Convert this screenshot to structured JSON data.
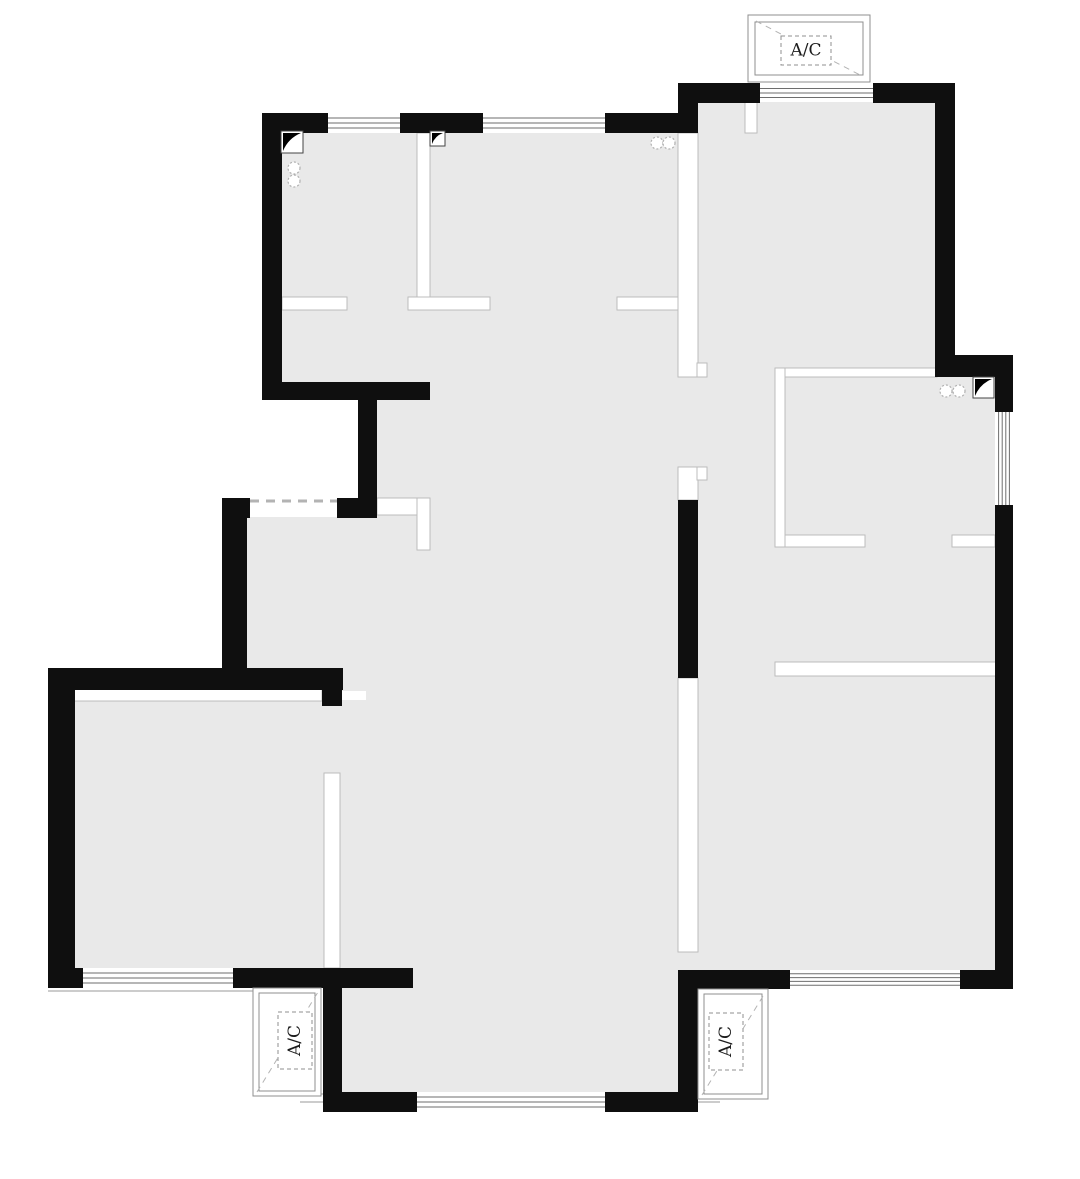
{
  "plan": {
    "canvas": {
      "width": 1080,
      "height": 1179,
      "background": "#ffffff"
    },
    "ac_label": "A/C",
    "colors": {
      "wall": "#0f0f0f",
      "floor": "#e9e9e9",
      "partition_fill": "#ffffff",
      "partition_stroke": "#bcbcbc",
      "glass_line": "#6e6e6e",
      "sill_line": "#9a9a9a",
      "platform_stroke": "#8f8f8f",
      "dash_line": "#b3b3b3",
      "label_text": "#1c1c1c",
      "flue_stroke": "#444444",
      "pipe_stroke": "#b0b0b0"
    },
    "floors": [
      [
        276,
        123,
        414,
        277
      ],
      [
        686,
        92,
        262,
        890
      ],
      [
        944,
        362,
        60,
        620
      ],
      [
        366,
        377,
        324,
        721
      ],
      [
        232,
        517,
        200,
        174
      ],
      [
        55,
        676,
        282,
        306
      ],
      [
        337,
        700,
        35,
        395
      ]
    ],
    "walls": [
      [
        262,
        113,
        20,
        287
      ],
      [
        262,
        113,
        66,
        20
      ],
      [
        400,
        113,
        83,
        20
      ],
      [
        605,
        113,
        93,
        20
      ],
      [
        678,
        100,
        20,
        33
      ],
      [
        678,
        83,
        82,
        20
      ],
      [
        873,
        83,
        82,
        20
      ],
      [
        935,
        95,
        20,
        282
      ],
      [
        935,
        355,
        78,
        22
      ],
      [
        995,
        377,
        18,
        35
      ],
      [
        995,
        505,
        18,
        484
      ],
      [
        698,
        970,
        92,
        19
      ],
      [
        960,
        970,
        53,
        19
      ],
      [
        678,
        500,
        20,
        178
      ],
      [
        678,
        970,
        20,
        142
      ],
      [
        323,
        1092,
        94,
        20
      ],
      [
        605,
        1092,
        93,
        20
      ],
      [
        323,
        970,
        19,
        142
      ],
      [
        48,
        968,
        35,
        20
      ],
      [
        233,
        968,
        180,
        20
      ],
      [
        48,
        672,
        27,
        316
      ],
      [
        48,
        668,
        295,
        22
      ],
      [
        322,
        668,
        20,
        38
      ],
      [
        222,
        498,
        25,
        192
      ],
      [
        222,
        498,
        28,
        20
      ],
      [
        337,
        498,
        40,
        20
      ],
      [
        358,
        400,
        19,
        100
      ],
      [
        282,
        382,
        148,
        18
      ]
    ],
    "partitions": [
      [
        417,
        133,
        13,
        164
      ],
      [
        282,
        297,
        65,
        13
      ],
      [
        408,
        297,
        82,
        13
      ],
      [
        617,
        297,
        61,
        13
      ],
      [
        678,
        133,
        20,
        244
      ],
      [
        697,
        363,
        10,
        14
      ],
      [
        678,
        467,
        20,
        33
      ],
      [
        697,
        467,
        10,
        13
      ],
      [
        377,
        498,
        53,
        17
      ],
      [
        417,
        498,
        13,
        52
      ],
      [
        775,
        368,
        10,
        179
      ],
      [
        785,
        368,
        152,
        9
      ],
      [
        785,
        535,
        80,
        12
      ],
      [
        952,
        535,
        43,
        12
      ],
      [
        775,
        662,
        223,
        14
      ],
      [
        68,
        688,
        254,
        13
      ],
      [
        324,
        773,
        16,
        195
      ],
      [
        678,
        678,
        20,
        274
      ],
      [
        745,
        100,
        12,
        33
      ]
    ],
    "windows": [
      {
        "x": 328,
        "y": 113,
        "w": 72,
        "h": 20,
        "n": 3,
        "o": "h"
      },
      {
        "x": 483,
        "y": 113,
        "w": 122,
        "h": 20,
        "n": 3,
        "o": "h"
      },
      {
        "x": 760,
        "y": 84,
        "w": 113,
        "h": 18,
        "n": 3,
        "o": "h"
      },
      {
        "x": 995,
        "y": 412,
        "w": 18,
        "h": 93,
        "n": 4,
        "o": "v"
      },
      {
        "x": 790,
        "y": 970,
        "w": 170,
        "h": 19,
        "n": 4,
        "o": "h"
      },
      {
        "x": 83,
        "y": 968,
        "w": 150,
        "h": 20,
        "n": 3,
        "o": "h"
      },
      {
        "x": 417,
        "y": 1092,
        "w": 188,
        "h": 20,
        "n": 3,
        "o": "h"
      }
    ],
    "sills": [
      [
        300,
        1094,
        720,
        1094
      ],
      [
        300,
        1102,
        720,
        1102
      ],
      [
        48,
        991,
        321,
        991
      ]
    ],
    "dashed_openings": [
      [
        250,
        501,
        337,
        501
      ]
    ],
    "flues": [
      {
        "x": 281,
        "y": 131,
        "s": 22
      },
      {
        "x": 430,
        "y": 131,
        "s": 15
      },
      {
        "x": 973,
        "y": 377,
        "s": 21
      }
    ],
    "pipes": [
      [
        294,
        168
      ],
      [
        294,
        181
      ],
      [
        657,
        143
      ],
      [
        669,
        143
      ],
      [
        946,
        391
      ],
      [
        959,
        391
      ]
    ],
    "ac_units": [
      {
        "outer": [
          748,
          15,
          122,
          67
        ],
        "inner": [
          755,
          22,
          108,
          53
        ],
        "label_box": [
          781,
          36,
          50,
          29
        ],
        "orient": "h",
        "diag": [
          756,
          21,
          862,
          76
        ]
      },
      {
        "outer": [
          253,
          988,
          68,
          108
        ],
        "inner": [
          259,
          993,
          56,
          98
        ],
        "label_box": [
          278,
          1012,
          34,
          57
        ],
        "orient": "v",
        "diag": [
          257,
          1092,
          318,
          992
        ]
      },
      {
        "outer": [
          698,
          989,
          70,
          110
        ],
        "inner": [
          704,
          994,
          58,
          100
        ],
        "label_box": [
          709,
          1013,
          34,
          57
        ],
        "orient": "v",
        "diag": [
          702,
          1095,
          765,
          993
        ]
      }
    ]
  }
}
